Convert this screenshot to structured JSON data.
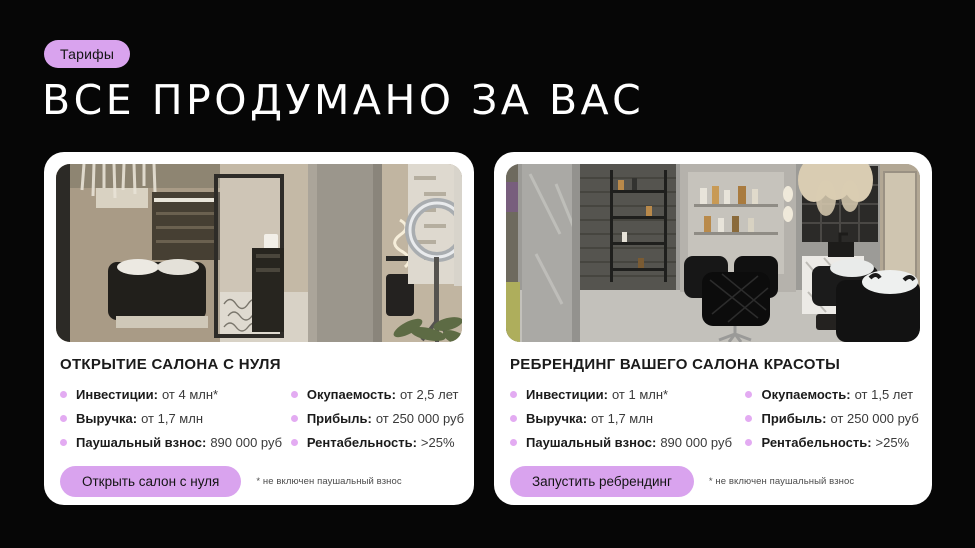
{
  "theme": {
    "bg": "#060606",
    "accent": "#d9a3ee",
    "bullet": "#e3abf2",
    "card_bg": "#ffffff",
    "heading_color": "#ffffff",
    "text_dark": "#1b1b1b",
    "text_value": "#3a3a3a",
    "footnote_color": "#4c4c4c"
  },
  "header": {
    "badge_label": "Тарифы",
    "title": "ВСЕ ПРОДУМАНО ЗА ВАС"
  },
  "cards": [
    {
      "title": "ОТКРЫТИЕ САЛОНА С НУЛЯ",
      "photo_name": "salon-interior-open-from-scratch",
      "features_left": [
        {
          "label": "Инвестиции:",
          "value": "от 4 млн*"
        },
        {
          "label": "Выручка:",
          "value": "от 1,7 млн"
        },
        {
          "label": "Паушальный взнос:",
          "value": "890 000 руб"
        }
      ],
      "features_right": [
        {
          "label": "Окупаемость:",
          "value": "от 2,5 лет"
        },
        {
          "label": "Прибыль:",
          "value": "от 250 000 руб"
        },
        {
          "label": "Рентабельность:",
          "value": ">25%"
        }
      ],
      "button_label": "Открыть салон с нуля",
      "footnote": "* не включен паушальный взнос"
    },
    {
      "title": "РЕБРЕНДИНГ ВАШЕГО САЛОНА КРАСОТЫ",
      "photo_name": "salon-interior-rebranding",
      "features_left": [
        {
          "label": "Инвестиции:",
          "value": "от 1 млн*"
        },
        {
          "label": "Выручка:",
          "value": "от 1,7 млн"
        },
        {
          "label": "Паушальный взнос:",
          "value": "890 000 руб"
        }
      ],
      "features_right": [
        {
          "label": "Окупаемость:",
          "value": "от 1,5 лет"
        },
        {
          "label": "Прибыль:",
          "value": "от 250 000 руб"
        },
        {
          "label": "Рентабельность:",
          "value": ">25%"
        }
      ],
      "button_label": "Запустить ребрендинг",
      "footnote": "* не включен паушальный взнос"
    }
  ]
}
